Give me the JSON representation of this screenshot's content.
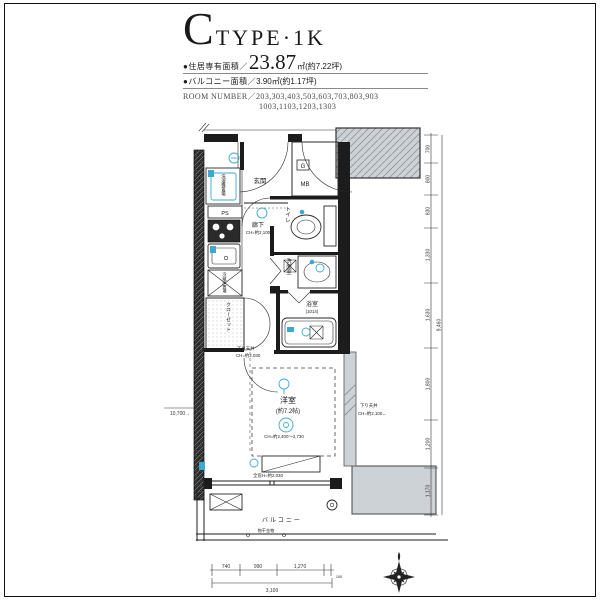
{
  "header": {
    "type_letter": "C",
    "type_rest": "TYPE·1K",
    "area_bullet": "●住居専有面積／",
    "area_value": "23.87",
    "area_suffix": "㎡(約7.22坪)",
    "balcony_bullet": "●バルコニー面積／",
    "balcony_value": "3.90㎡(約1.17坪)",
    "room_number_label": "ROOM NUMBER／",
    "room_numbers_1": "203,303,403,503,603,703,803,903",
    "room_numbers_2": "1003,1103,1203,1303"
  },
  "plan": {
    "rooms": {
      "genkan": "玄関",
      "gas": "G",
      "mb": "MB",
      "toilet": "トイレ",
      "hallway": "廊下",
      "hallway_ch": "CH=約2,100",
      "washroom": "洗面室",
      "bathroom": "浴室",
      "bathroom_size": "(1014)",
      "washer": "洗濯機置場",
      "ps": "PS",
      "fridge": "冷蔵庫置場",
      "closet": "クローゼット",
      "western": "洋室",
      "western_size": "(約7.2帖)",
      "western_ch": "CH=約2,400〜2,730",
      "window_note": "全窓H=約2,030",
      "balcony": "バルコニー",
      "laundry": "物干金物"
    },
    "notes": {
      "dropped_left_1": "下り天井",
      "dropped_left_2": "CH=約2,030",
      "dropped_right_1": "下り天井",
      "dropped_right_2": "CH=約2,100←"
    }
  },
  "dimensions": {
    "left_total": "10,700→",
    "right_segments": [
      "700",
      "800",
      "830",
      "1,330",
      "1,630",
      "1,800",
      "1,200",
      "1,170"
    ],
    "right_total": "9,460",
    "bottom_segments": [
      "740",
      "990",
      "1,270",
      "100"
    ],
    "bottom_total": "3,100"
  }
}
